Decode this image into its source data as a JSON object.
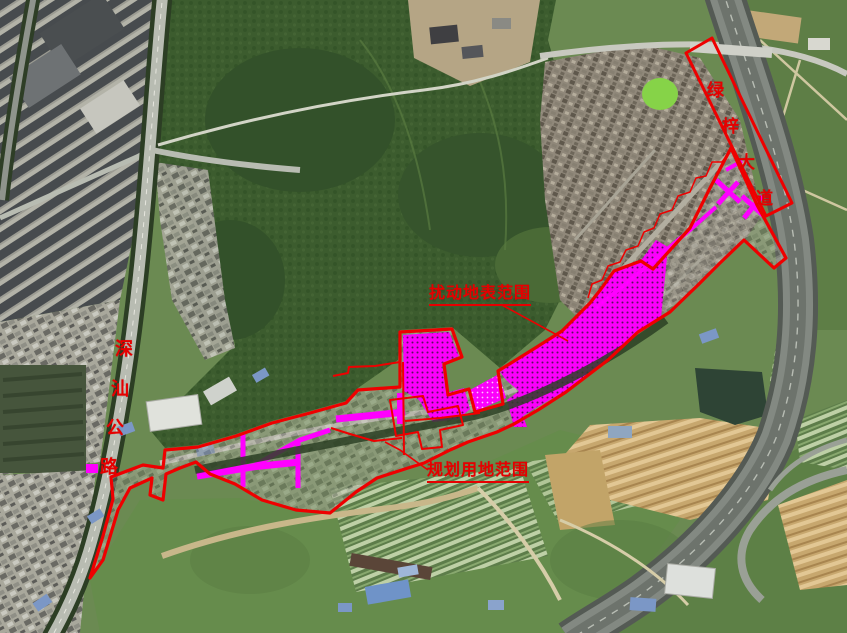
{
  "map": {
    "type": "satellite-planning-map",
    "annotations": {
      "disturbed_area_label": "扰动地表范围",
      "planning_area_label": "规划用地范围",
      "shenshan_road": {
        "full": "深汕公路",
        "chars": [
          "深",
          "汕",
          "公",
          "路"
        ]
      },
      "luzi_avenue": {
        "full": "绿梓大道",
        "chars": [
          "绿",
          "梓",
          "大",
          "道"
        ]
      }
    },
    "colors": {
      "boundary_red": "#ee0000",
      "label_red": "#e60000",
      "disturbed_fill_magenta": "#ff00ff"
    }
  }
}
